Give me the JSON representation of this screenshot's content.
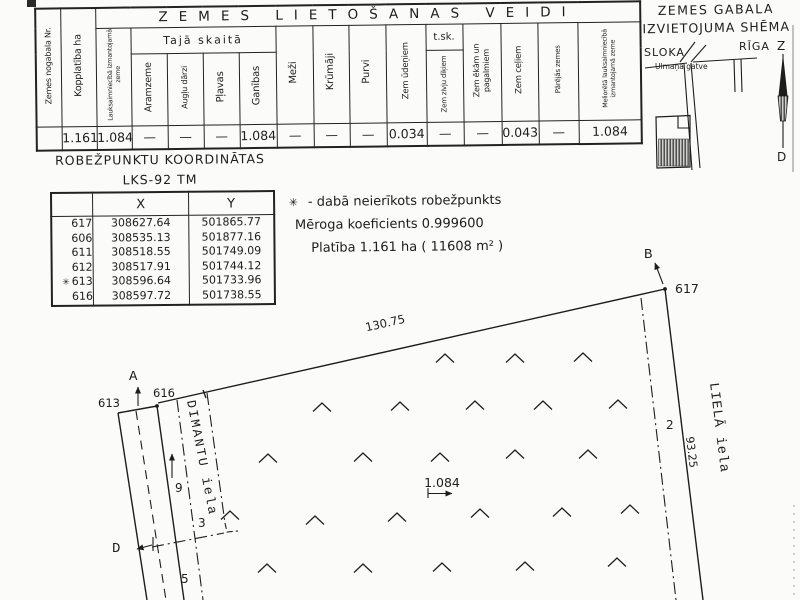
{
  "land_use_table": {
    "title": "ZEMES LIETOŠANAS VEIDI",
    "col_parcel": "Zemes nogabala Nr.",
    "col_total": "Kopplatība ha",
    "col_agri": "Lauksaimniecībā izmantojamā zeme",
    "group_included": "Tajā skaitā",
    "col_arable": "Aramzeme",
    "col_orchards": "Augļu dārzi",
    "col_meadows": "Pļavas",
    "col_pastures": "Ganības",
    "col_forests": "Meži",
    "col_shrubs": "Krūmāji",
    "col_swamps": "Purvi",
    "col_water": "Zem ūdeņiem",
    "group_tsk": "t.sk.",
    "col_fishponds": "Zem zivju dīķiem",
    "col_buildings": "Zem ēkām un pagalmiem",
    "col_roads": "Zem ceļiem",
    "col_other": "Pārējās zemes",
    "col_ameliorated": "Meliorētā lauksaimniecībā izmantojamā zeme",
    "values": [
      "",
      "1.161",
      "1.084",
      "—",
      "—",
      "—",
      "1.084",
      "—",
      "—",
      "—",
      "0.034",
      "—",
      "—",
      "0.043",
      "—",
      "1.084"
    ]
  },
  "coords_table": {
    "title": "ROBEŽPUNKTU KOORDINĀTAS",
    "subtitle": "LKS-92 TM",
    "col_x": "X",
    "col_y": "Y",
    "rows": [
      {
        "star": "",
        "pt": "617",
        "x": "308627.64",
        "y": "501865.77"
      },
      {
        "star": "",
        "pt": "606",
        "x": "308535.13",
        "y": "501877.16"
      },
      {
        "star": "",
        "pt": "611",
        "x": "308518.55",
        "y": "501749.09"
      },
      {
        "star": "",
        "pt": "612",
        "x": "308517.91",
        "y": "501744.12"
      },
      {
        "star": "✳",
        "pt": "613",
        "x": "308596.64",
        "y": "501733.96"
      },
      {
        "star": "",
        "pt": "616",
        "x": "308597.72",
        "y": "501738.55"
      }
    ]
  },
  "legend": {
    "star": "✳",
    "star_note": "-  dabā neierīkots robežpunkts",
    "scale_note": "Mēroga koeficients 0.999600",
    "area_note": "Platība 1.161 ha ( 11608 m² )"
  },
  "schema": {
    "title_line1": "ZEMES GABALA",
    "title_line2": "IZVIETOJUMA SHĒMA",
    "left_city": "SLOKA",
    "right_city": "RĪGA",
    "road": "Ulmaņa gatve"
  },
  "compass": {
    "north": "Z",
    "south": "D"
  },
  "plan": {
    "label_a": "A",
    "label_b": "B",
    "label_d": "D",
    "pt_617": "617",
    "pt_616": "616",
    "pt_613": "613",
    "dim_top": "130.75",
    "dim_right": "93.25",
    "area": "1.084",
    "street_dimantu": "DIMANTU iela",
    "street_liela": "LIELĀ iela",
    "num_2": "2",
    "num_3": "3",
    "num_5": "5",
    "num_9": "9"
  }
}
